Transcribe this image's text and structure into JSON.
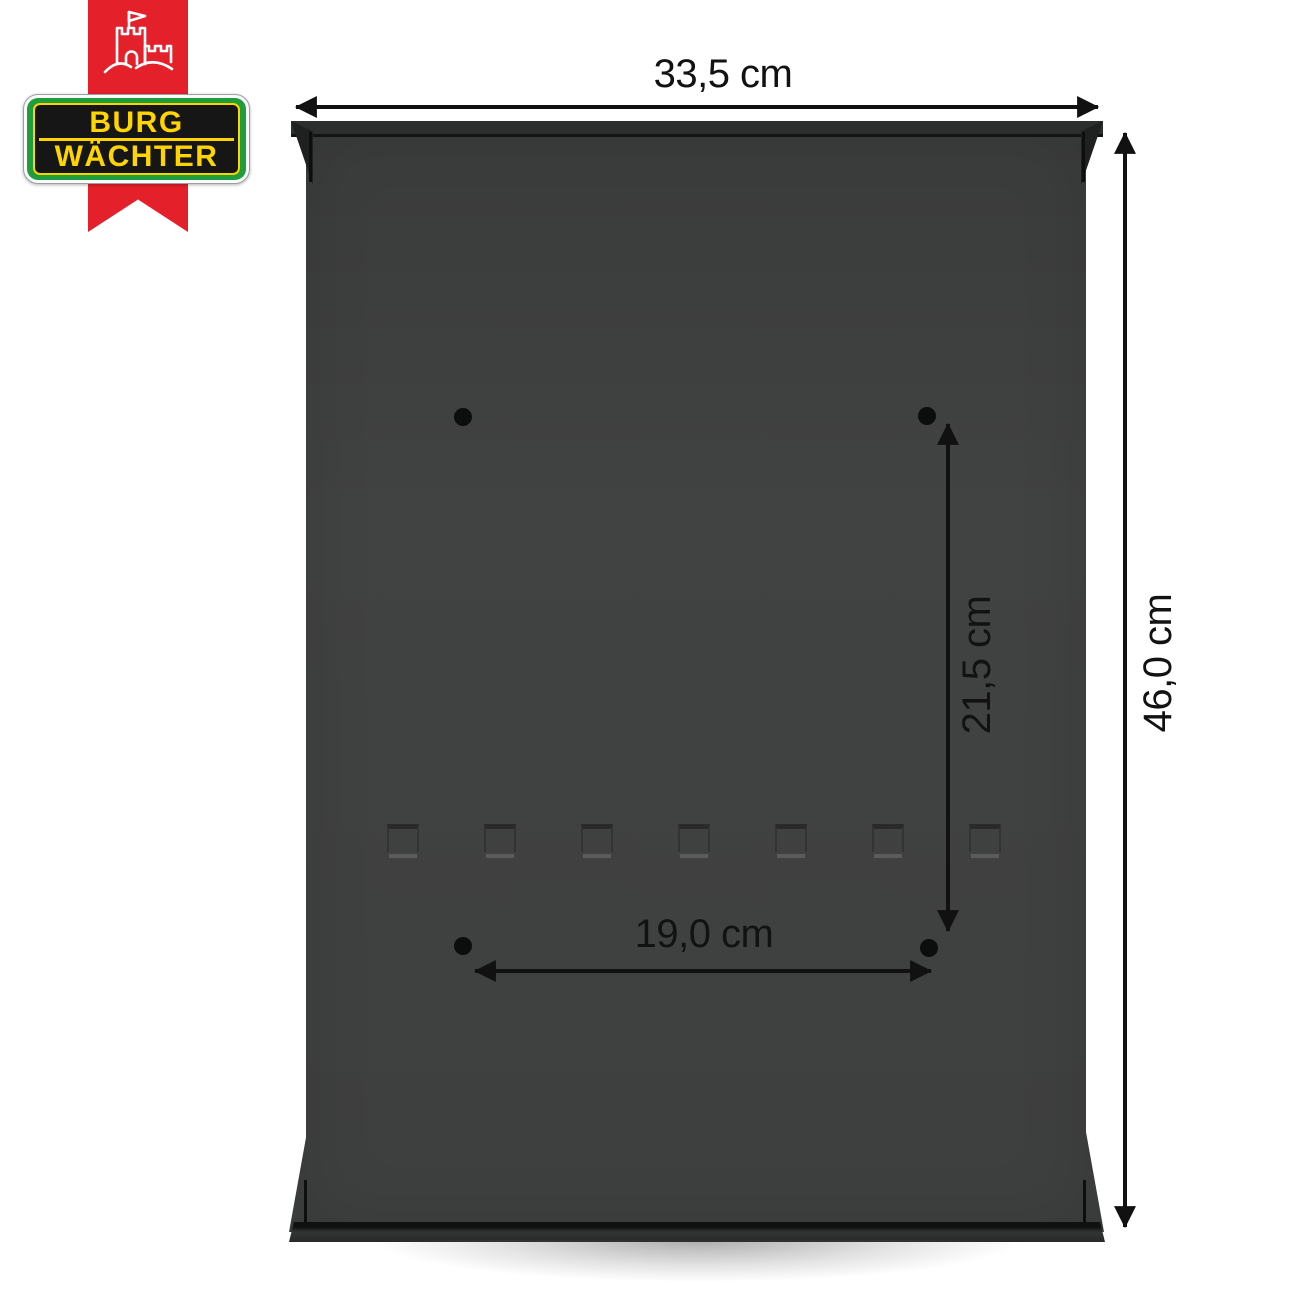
{
  "brand": {
    "word1": "BURG",
    "word2": "WÄCHTER",
    "colors": {
      "ribbon_red": "#e4202b",
      "badge_green": "#1f9d3c",
      "accent_yellow": "#ffd400",
      "badge_black": "#161616"
    },
    "castle_icon": "white castle outline with flag"
  },
  "product": {
    "body_color": "#3e3f3f",
    "mounting_hole_count": 4,
    "emboss_mark_count": 7
  },
  "dimensions": {
    "overall_width": "33,5 cm",
    "overall_height": "46,0 cm",
    "hole_spacing_vertical": "21,5 cm",
    "hole_spacing_horizontal": "19,0 cm"
  }
}
